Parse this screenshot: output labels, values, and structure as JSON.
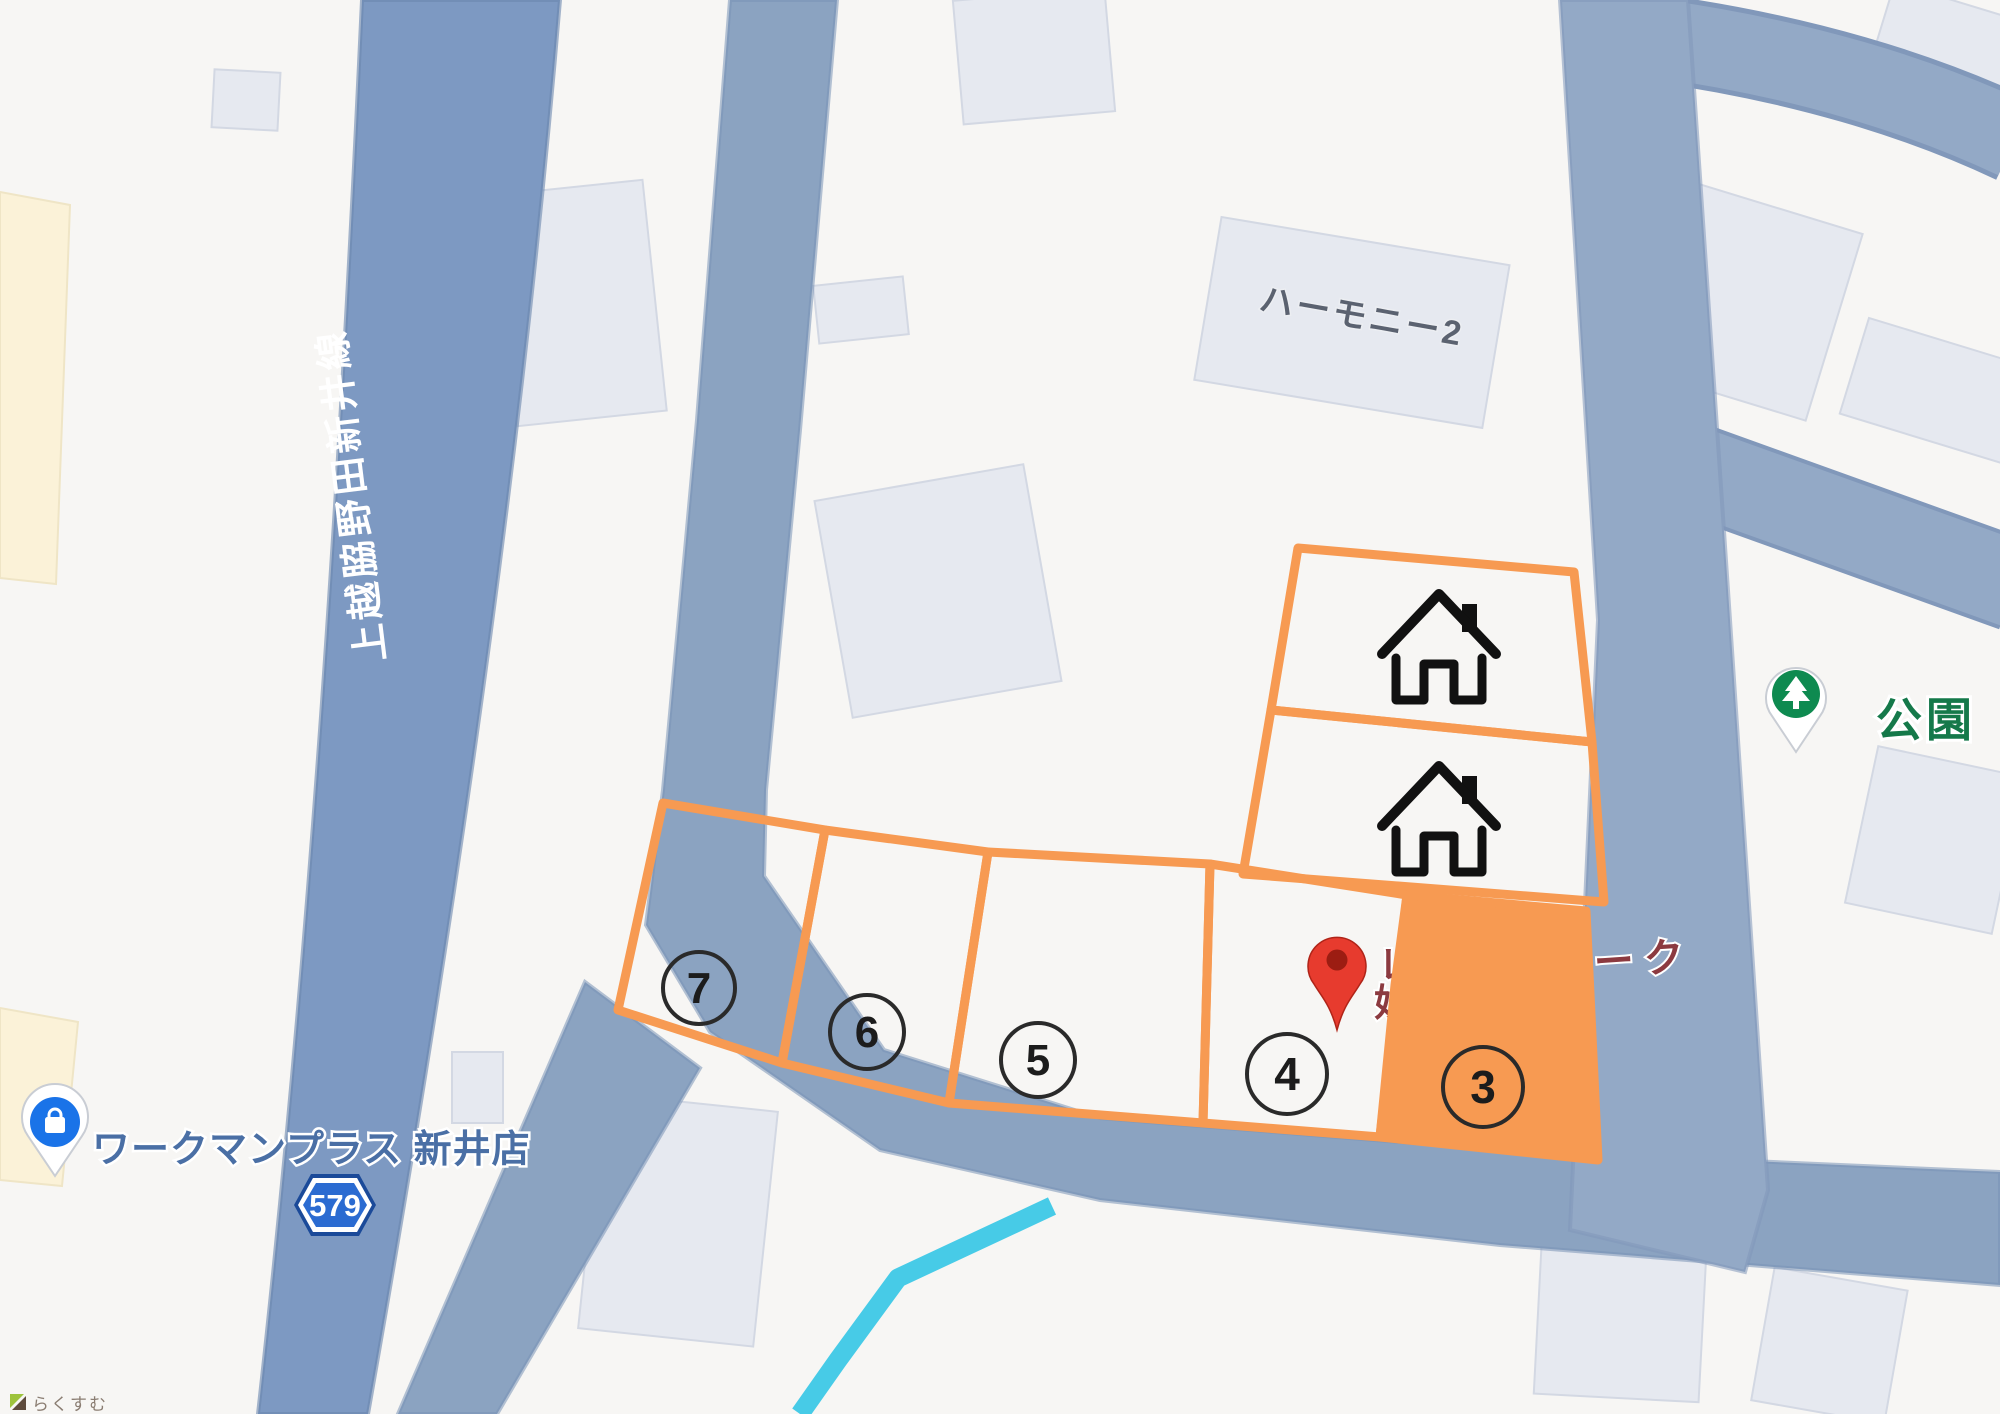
{
  "map": {
    "road_labels": {
      "prefectural_route_name": "上越脇野田新井線",
      "route_shield": "579"
    },
    "pois": {
      "park": {
        "label": "公園",
        "pin_color": "#0e8a50",
        "text_color": "#15794a"
      },
      "store": {
        "label": "ワークマンプラス 新井店",
        "pin_color": "#1a73e8",
        "text_color": "#4a6fa5"
      },
      "building": {
        "label": "ハーモニー2",
        "text_color": "#5b6270"
      },
      "red_place": {
        "fragment_line1": "レ",
        "fragment_line2": "妙",
        "fragment_right": "パーク",
        "text_color": "#8c3a40",
        "pin_color": "#e73b2e"
      }
    },
    "lots": {
      "outline_color": "#f79a52",
      "highlighted_number": "3",
      "items": [
        {
          "number": "7"
        },
        {
          "number": "6"
        },
        {
          "number": "5"
        },
        {
          "number": "4"
        },
        {
          "number": "3"
        }
      ]
    },
    "shield": {
      "fill": "#2b6bd1",
      "text": "579"
    },
    "stream_color": "#47cbe7",
    "watermark": "らくすむ"
  }
}
